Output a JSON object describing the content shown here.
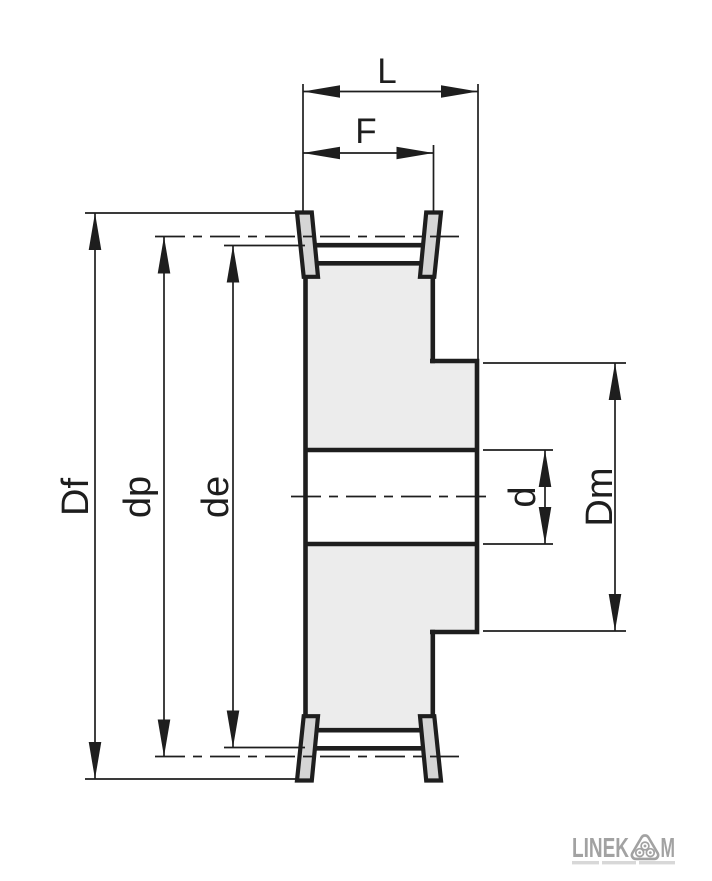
{
  "dims": {
    "L": "L",
    "F": "F",
    "Df": "Df",
    "dp": "dp",
    "de": "de",
    "d": "d",
    "Dm": "Dm"
  },
  "logo": {
    "text_left": "LINEK",
    "text_right": "M",
    "emblem": "three-roller-triangle-icon"
  },
  "colors": {
    "line": "#1e1e1e",
    "body_fill": "#ececec",
    "flange_fill": "#d5d5d5",
    "logo_gray": "#a2a2a2"
  }
}
